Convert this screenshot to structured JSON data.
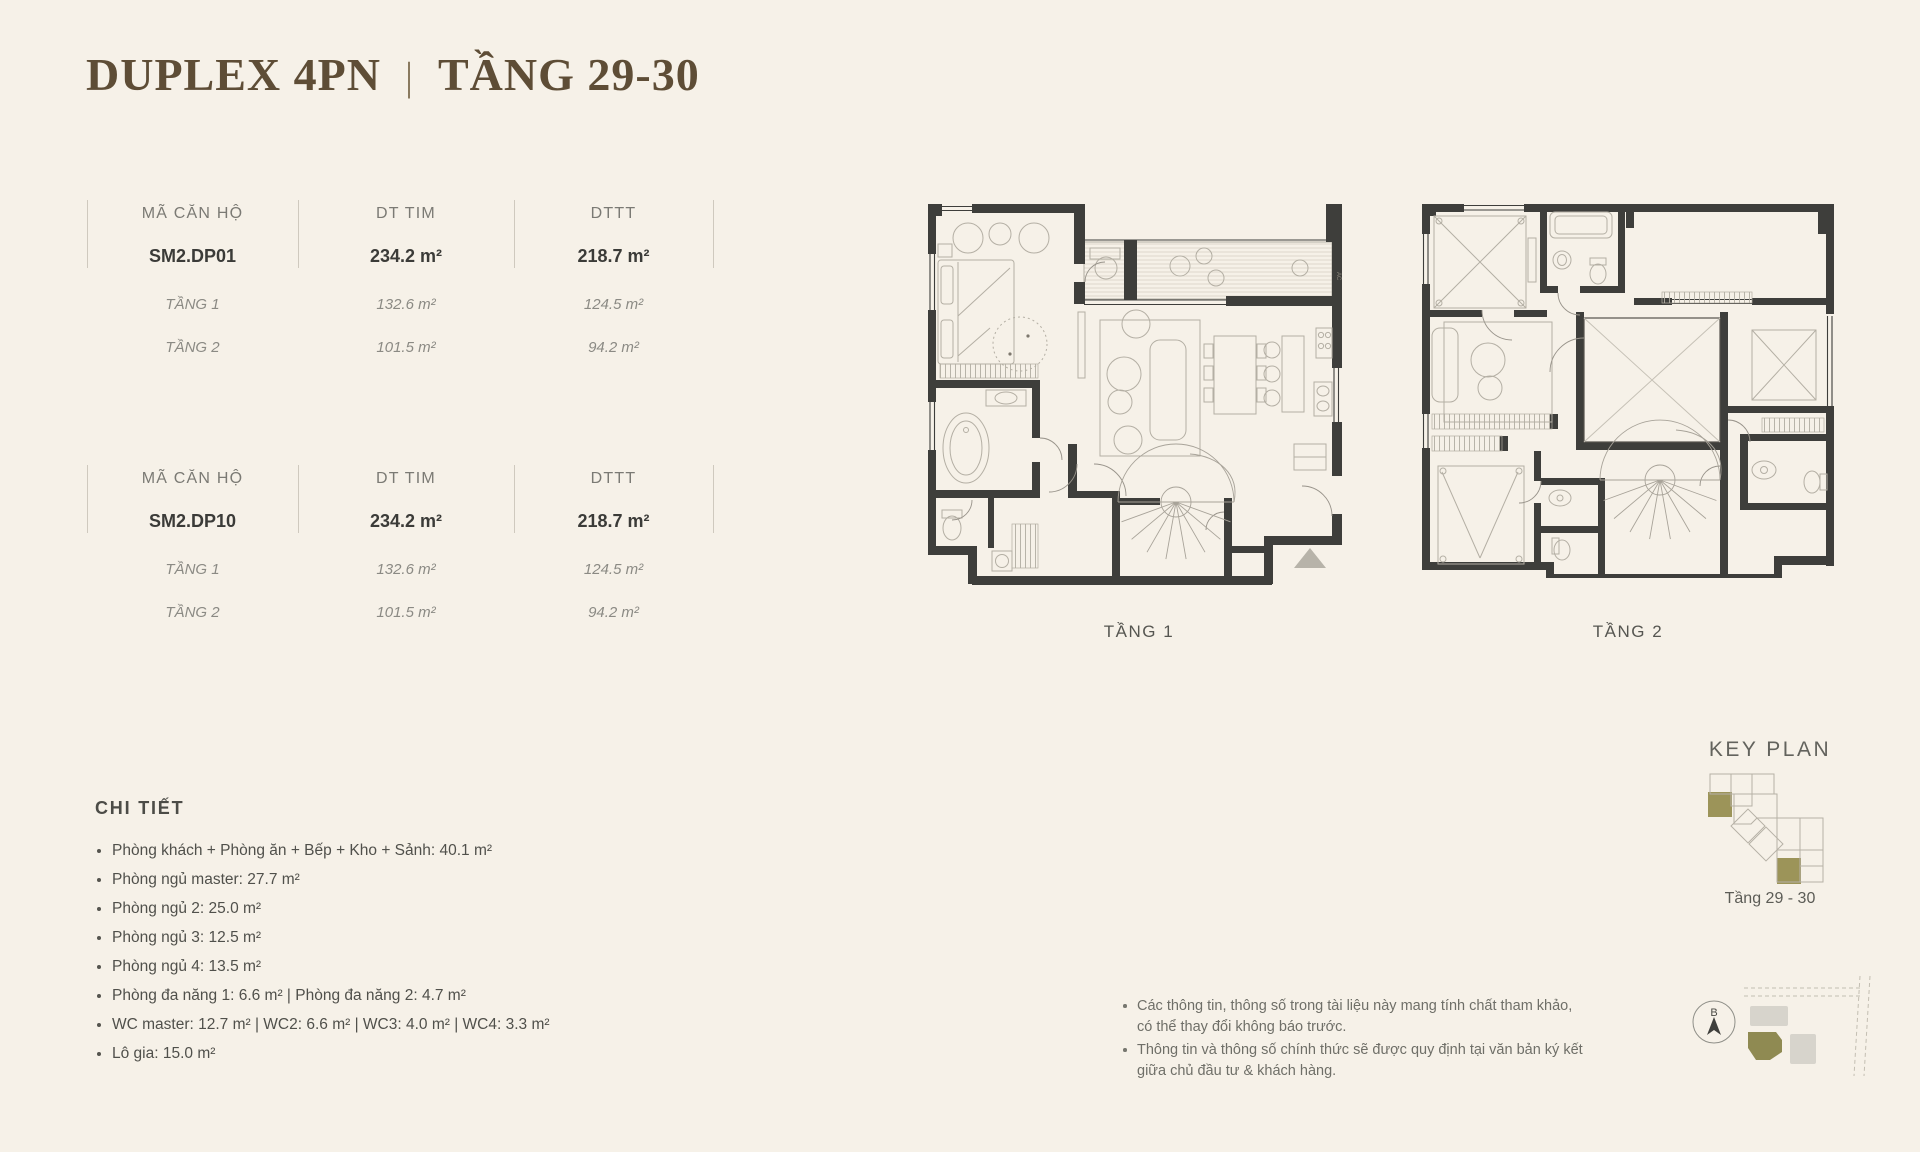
{
  "title": {
    "left": "DUPLEX 4PN",
    "separator": "|",
    "right": "TẦNG 29-30"
  },
  "tables": [
    {
      "headers": [
        "MÃ CĂN HỘ",
        "DT TIM",
        "DTTT"
      ],
      "unit": [
        "SM2.DP01",
        "234.2 m²",
        "218.7 m²"
      ],
      "floors": [
        [
          "TẦNG 1",
          "132.6 m²",
          "124.5 m²"
        ],
        [
          "TẦNG 2",
          "101.5 m²",
          "94.2 m²"
        ]
      ]
    },
    {
      "headers": [
        "MÃ CĂN HỘ",
        "DT TIM",
        "DTTT"
      ],
      "unit": [
        "SM2.DP10",
        "234.2 m²",
        "218.7 m²"
      ],
      "floors": [
        [
          "TẦNG 1",
          "132.6 m²",
          "124.5 m²"
        ],
        [
          "TẦNG 2",
          "101.5 m²",
          "94.2 m²"
        ]
      ]
    }
  ],
  "plans": [
    {
      "label": "TẦNG 1",
      "ac_label": "AC"
    },
    {
      "label": "TẦNG 2"
    }
  ],
  "details": {
    "heading": "CHI TIẾT",
    "items": [
      "Phòng khách + Phòng ăn + Bếp + Kho + Sảnh: 40.1 m²",
      "Phòng ngủ master: 27.7 m²",
      "Phòng ngủ 2: 25.0 m²",
      "Phòng ngủ 3: 12.5 m²",
      "Phòng ngủ 4: 13.5 m²",
      "Phòng đa năng 1: 6.6 m² |  Phòng đa năng 2: 4.7 m²",
      "WC master: 12.7 m² | WC2: 6.6 m² | WC3: 4.0 m² | WC4: 3.3 m²",
      "Lô gia: 15.0 m²"
    ]
  },
  "notes": {
    "items": [
      "Các thông tin, thông số trong tài liệu này mang tính chất tham khảo,\ncó thể thay đổi không báo trước.",
      "Thông tin và thông số chính thức sẽ được quy định tại văn bản ký kết\ngiữa chủ đầu tư & khách hàng."
    ]
  },
  "key_plan": {
    "title": "KEY PLAN",
    "caption": "Tầng 29 - 30"
  },
  "compass": {
    "north_label": "B"
  },
  "colors": {
    "background": "#f6f1e8",
    "title_brown": "#5e4d36",
    "accent_olive": "#9c9459",
    "wall_dark": "#3e3e3b"
  }
}
